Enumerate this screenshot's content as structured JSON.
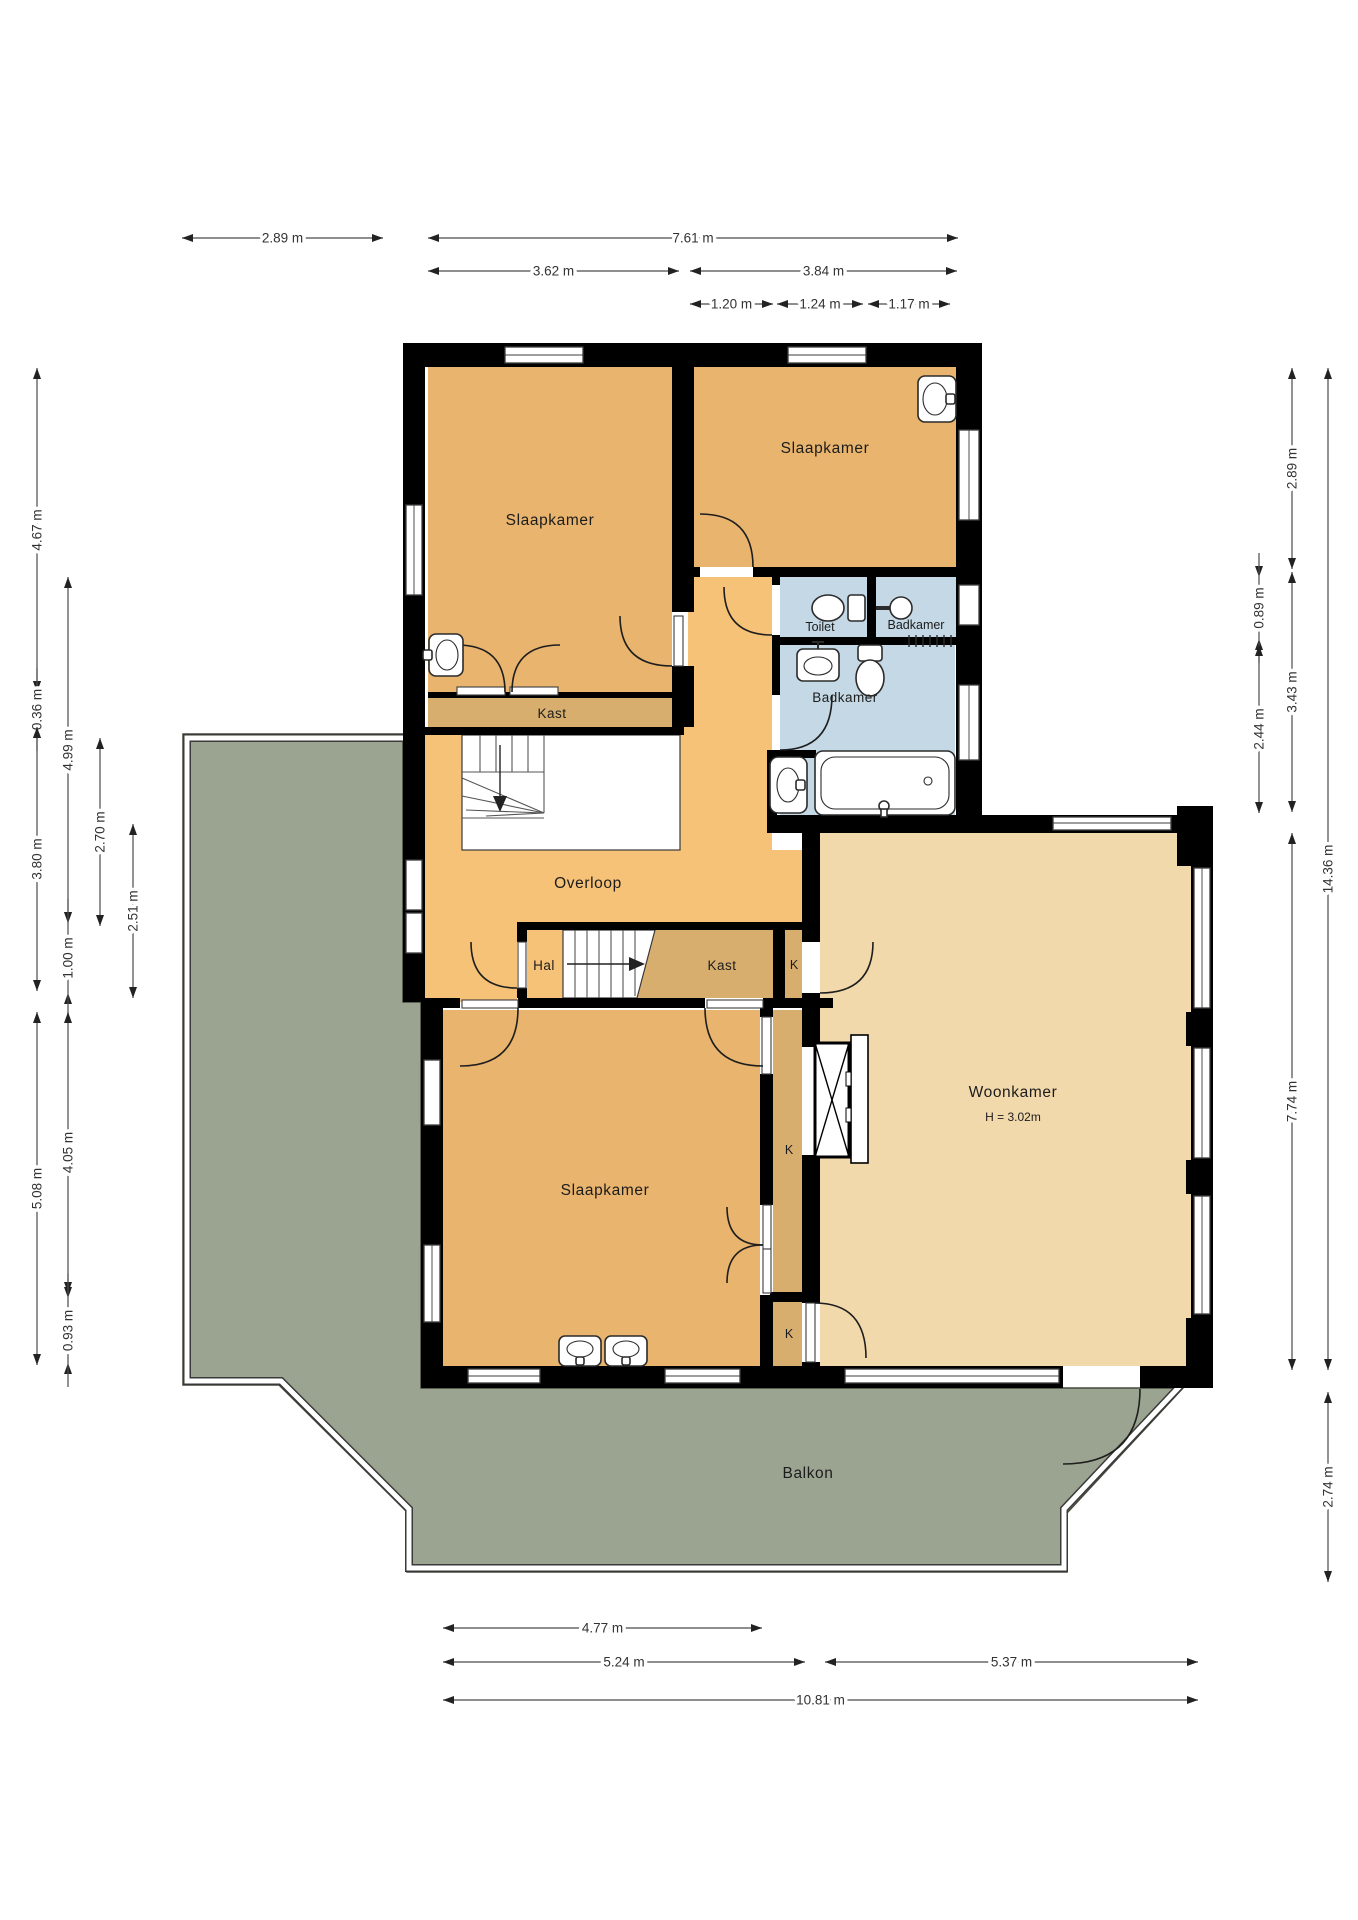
{
  "rooms": [
    {
      "id": "bedroom-top-left",
      "label": "Slaapkamer"
    },
    {
      "id": "bedroom-top-right",
      "label": "Slaapkamer"
    },
    {
      "id": "toilet",
      "label": "Toilet"
    },
    {
      "id": "bathroom-upper",
      "label": "Badkamer"
    },
    {
      "id": "bathroom-main",
      "label": "Badkamer"
    },
    {
      "id": "closet-top",
      "label": "Kast"
    },
    {
      "id": "landing",
      "label": "Overloop"
    },
    {
      "id": "hall",
      "label": "Hal"
    },
    {
      "id": "closet-mid",
      "label": "Kast"
    },
    {
      "id": "k-top",
      "label": "K"
    },
    {
      "id": "k-mid",
      "label": "K"
    },
    {
      "id": "k-bottom",
      "label": "K"
    },
    {
      "id": "bedroom-bottom",
      "label": "Slaapkamer"
    },
    {
      "id": "living-room",
      "label": "Woonkamer",
      "sublabel": "H = 3.02m"
    },
    {
      "id": "balcony",
      "label": "Balkon"
    }
  ],
  "dimensions": {
    "top": [
      "2.89 m",
      "7.61 m",
      "3.62 m",
      "3.84 m",
      "1.20 m",
      "1.24 m",
      "1.17 m"
    ],
    "bottom": [
      "4.77 m",
      "5.24 m",
      "5.37 m",
      "10.81 m"
    ],
    "left": [
      "4.67 m",
      "0.36 m",
      "3.80 m",
      "5.08 m",
      "4.99 m",
      "1.00 m",
      "4.05 m",
      "0.93 m",
      "2.70 m",
      "2.51 m"
    ],
    "right": [
      "0.89 m",
      "2.44 m",
      "2.89 m",
      "3.43 m",
      "7.74 m",
      "14.36 m",
      "2.74 m"
    ]
  },
  "colors": {
    "wall": "#000000",
    "bedroom": "#e9b46e",
    "landing": "#f6c277",
    "closet": "#d8ae6f",
    "living": "#f2d9ac",
    "bathroom": "#c5d8e5",
    "balcony": "#9ba491",
    "fixture": "#ffffff",
    "dimension": "#4a4a4a"
  }
}
